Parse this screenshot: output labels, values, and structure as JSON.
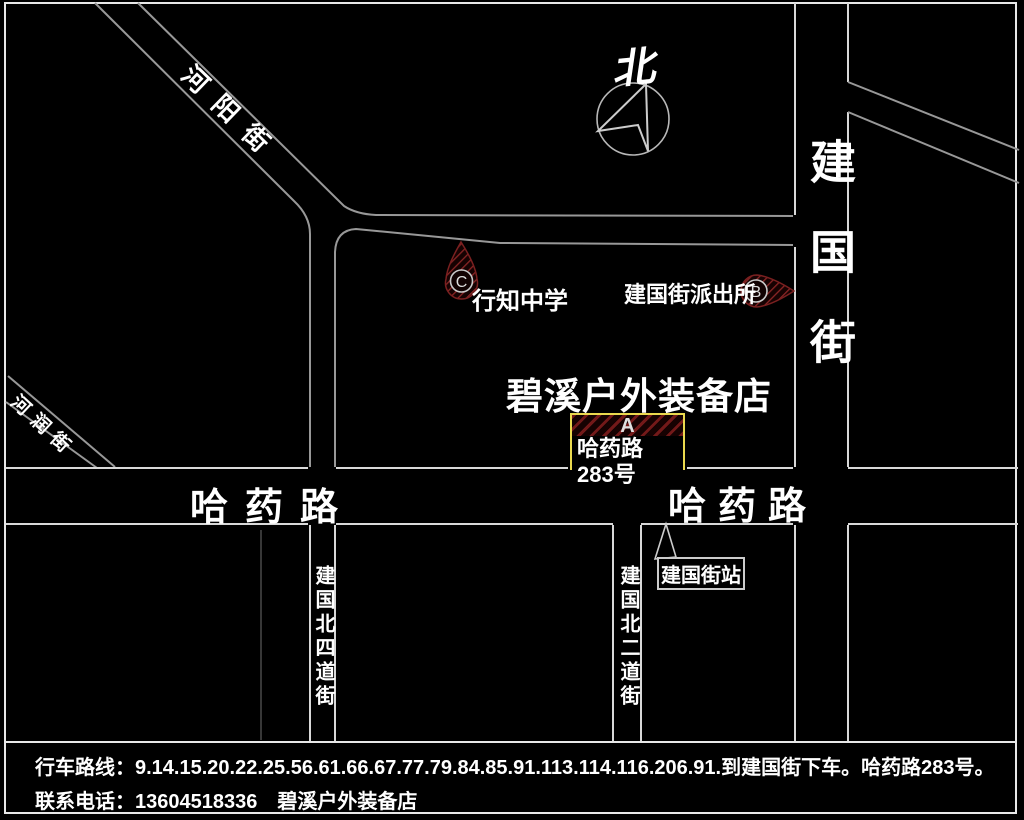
{
  "map": {
    "compass_label": "北",
    "streets": {
      "heyang": "河阳街",
      "herun": "河润街",
      "jianguo": "建国街",
      "hayao_left": "哈药路",
      "hayao_right": "哈药路",
      "jianguo_n4": "建国北四道街",
      "jianguo_n2": "建国北二道街"
    },
    "pois": {
      "store_title": "碧溪户外装备店",
      "marker_a": {
        "letter": "A",
        "label": "哈药路283号"
      },
      "marker_b": {
        "letter": "B",
        "label": "建国街派出所"
      },
      "marker_c": {
        "letter": "C",
        "label": "行知中学"
      },
      "station": {
        "label": "建国街站"
      }
    }
  },
  "footer": {
    "route_line": "行车路线：9.14.15.20.22.25.56.61.66.67.77.79.84.85.91.113.114.116.206.91.到建国街下车。哈药路283号。",
    "phone_line": "联系电话：13604518336　碧溪户外装备店"
  },
  "colors": {
    "background": "#000000",
    "road_line": "#c8c8c8",
    "diagonal_road_line": "#989898",
    "frame": "#e8e8e8",
    "marker_fill_dark": "#160202",
    "marker_hatch_red": "#8a2525",
    "a_box_border_yellow": "#ead94e",
    "text": "#ffffff"
  }
}
